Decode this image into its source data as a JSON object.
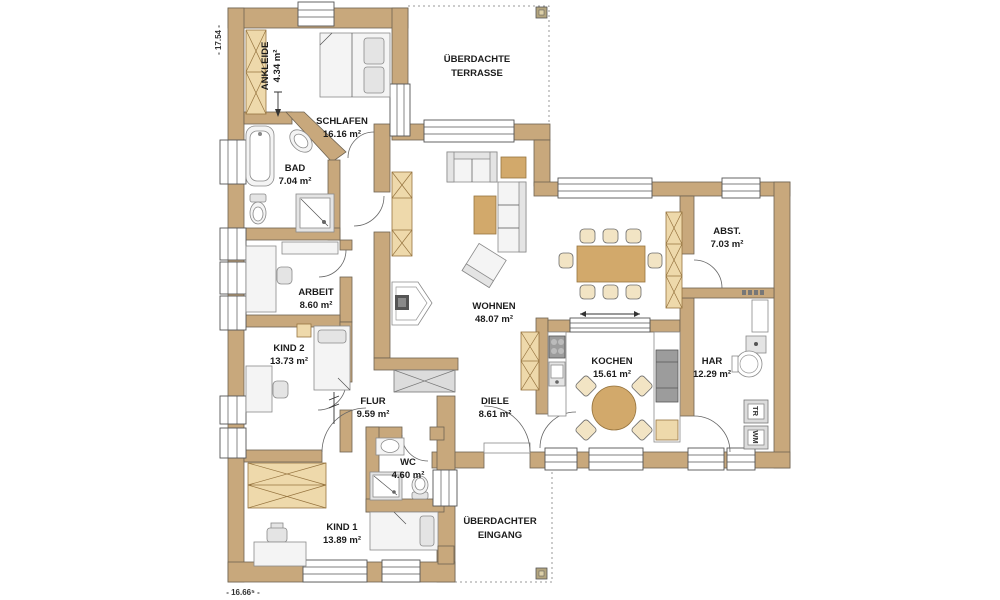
{
  "rooms": [
    {
      "name": "ANKLEIDE",
      "area": "4.34 m²"
    },
    {
      "name": "SCHLAFEN",
      "area": "16.16 m²"
    },
    {
      "name": "BAD",
      "area": "7.04 m²"
    },
    {
      "name": "ARBEIT",
      "area": "8.60 m²"
    },
    {
      "name": "KIND 2",
      "area": "13.73 m²"
    },
    {
      "name": "FLUR",
      "area": "9.59 m²"
    },
    {
      "name": "WC",
      "area": "4.60 m²"
    },
    {
      "name": "KIND 1",
      "area": "13.89 m²"
    },
    {
      "name": "WOHNEN",
      "area": "48.07 m²"
    },
    {
      "name": "DIELE",
      "area": "8.61 m²"
    },
    {
      "name": "KOCHEN",
      "area": "15.61 m²"
    },
    {
      "name": "HAR",
      "area": "12.29 m²"
    },
    {
      "name": "ABST.",
      "area": "7.03 m²"
    }
  ],
  "outdoor": {
    "terrace": {
      "line1": "ÜBERDACHTE",
      "line2": "TERRASSE"
    },
    "entrance": {
      "line1": "ÜBERDACHTER",
      "line2": "EINGANG"
    }
  },
  "appliances": {
    "dryer_label": "TR",
    "washer_label": "WM"
  },
  "dimensions": {
    "left": "- 17.54 -",
    "bottom": "- 16.66⁵ -"
  },
  "colors": {
    "wall": "#c8a87c",
    "wood": "#d2a96b",
    "wood_light": "#eed9ab",
    "outline": "#6e6352"
  }
}
